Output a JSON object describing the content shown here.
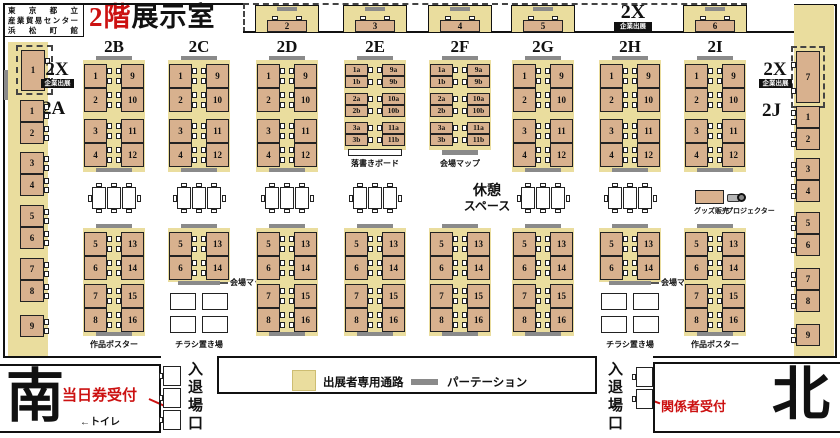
{
  "venue": {
    "name_lines": [
      "東京都立",
      "産業貿易センター",
      "浜松町館"
    ]
  },
  "title": {
    "floor": "2階",
    "room": "展示室"
  },
  "corporate": {
    "code": "2X",
    "badge": "企業出展"
  },
  "compass": {
    "south": "南",
    "north": "北"
  },
  "entrance": {
    "gate": "入退場口",
    "day_ticket": "当日券受付",
    "staff": "関係者受付",
    "toilet": "←トイレ"
  },
  "legend": {
    "passage": "出展者専用通路",
    "partition": "パーテーション"
  },
  "facilities": {
    "rest1": "休憩",
    "rest2": "スペース",
    "board": "落書きボード",
    "map": "会場マップ",
    "goods": "グッズ販売",
    "projector": "プロジェクター",
    "screen": "スクリーン",
    "poster": "作品ポスター",
    "flyer": "チラシ置き場"
  },
  "colors": {
    "booth": "#d8b18e",
    "passage": "#eadd9e",
    "partition": "#8a8a8a",
    "red": "#cc1111",
    "wall": "#111111"
  },
  "numbering": {
    "standard_top_left": [
      "1",
      "2",
      "3",
      "4"
    ],
    "standard_top_right": [
      "9",
      "10",
      "11",
      "12"
    ],
    "standard_bottom_left": [
      "5",
      "6",
      "7",
      "8"
    ],
    "standard_bottom_right": [
      "13",
      "14",
      "15",
      "16"
    ],
    "flyer_bottom_left": [
      "5",
      "6"
    ],
    "flyer_bottom_right": [
      "13",
      "14"
    ],
    "half_top_left": [
      "1a",
      "1b",
      "2a",
      "2b",
      "3a",
      "3b"
    ],
    "half_top_right": [
      "9a",
      "9b",
      "10a",
      "10b",
      "11a",
      "11b"
    ]
  },
  "columns": [
    {
      "label": "2B",
      "cx": 114,
      "type": "standard",
      "note": "poster"
    },
    {
      "label": "2C",
      "cx": 199,
      "type": "flyer"
    },
    {
      "label": "2D",
      "cx": 287,
      "type": "standard"
    },
    {
      "label": "2E",
      "cx": 375,
      "type": "half",
      "board": "board",
      "board_style": "white"
    },
    {
      "label": "2F",
      "cx": 460,
      "type": "half",
      "board": "map",
      "board_style": "gray"
    },
    {
      "label": "2G",
      "cx": 543,
      "type": "standard"
    },
    {
      "label": "2H",
      "cx": 630,
      "type": "flyer"
    },
    {
      "label": "2I",
      "cx": 715,
      "type": "standard",
      "note": "poster"
    }
  ],
  "top_booths": [
    {
      "num": "2",
      "cx": 287
    },
    {
      "num": "3",
      "cx": 375
    },
    {
      "num": "4",
      "cx": 460
    },
    {
      "num": "5",
      "cx": 543
    },
    {
      "num": "6",
      "cx": 715
    }
  ],
  "side": {
    "left": {
      "zone": "2A",
      "corp": "1",
      "booths": [
        "1",
        "2",
        "3",
        "4",
        "5",
        "6",
        "7",
        "8",
        "9"
      ]
    },
    "right": {
      "zone": "2J",
      "corp": "7",
      "booths": [
        "1",
        "2",
        "3",
        "4",
        "5",
        "6",
        "7",
        "8",
        "9"
      ]
    }
  },
  "mid_tables": [
    114,
    199,
    287,
    375,
    543,
    630
  ]
}
